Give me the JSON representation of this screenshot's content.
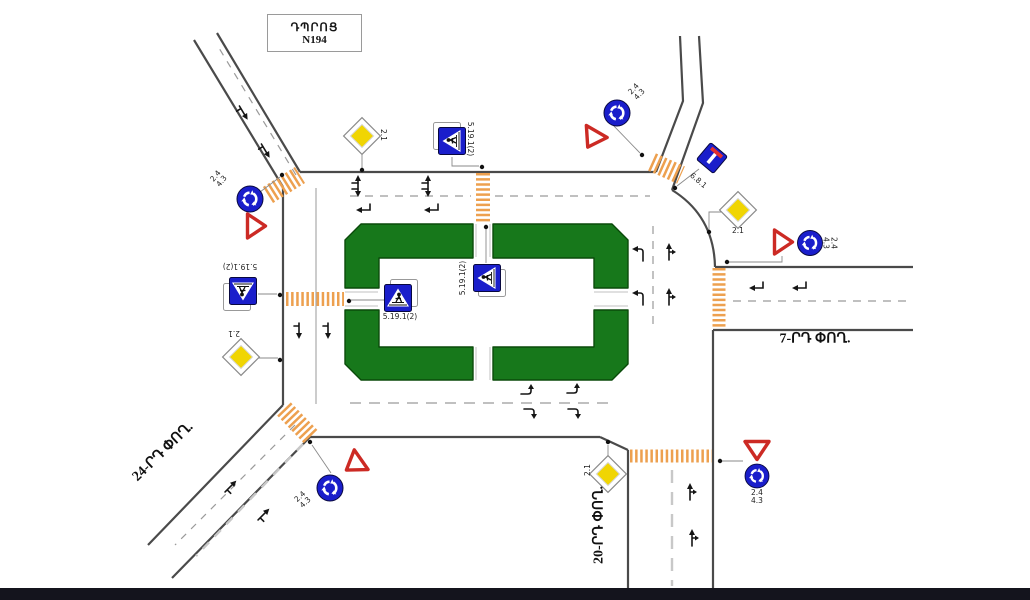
{
  "school": {
    "name": "ԴՊՐՈՑ",
    "number": "N194"
  },
  "streets": {
    "street_7": "7-ՐԴ ՓՈՂ.",
    "street_24": "24-ՐԴ ՓՈՂ.",
    "street_20": "20-ՐԴ ՓՈՂ."
  },
  "sign_codes": {
    "priority_road": "2.1",
    "pedestrian_crossing": "5.19.1(2)",
    "give_way": "2.4",
    "roundabout": "4.3",
    "dead_end": "6.8.1"
  },
  "colors": {
    "island_green": "#17781b",
    "crosswalk_orange": "#eda04f",
    "sign_blue": "#1a1ecb",
    "giveway_red": "#cc2a24",
    "priority_yellow": "#f0d503",
    "road_line": "#4a4a4a",
    "footer_bar": "#14141d"
  }
}
